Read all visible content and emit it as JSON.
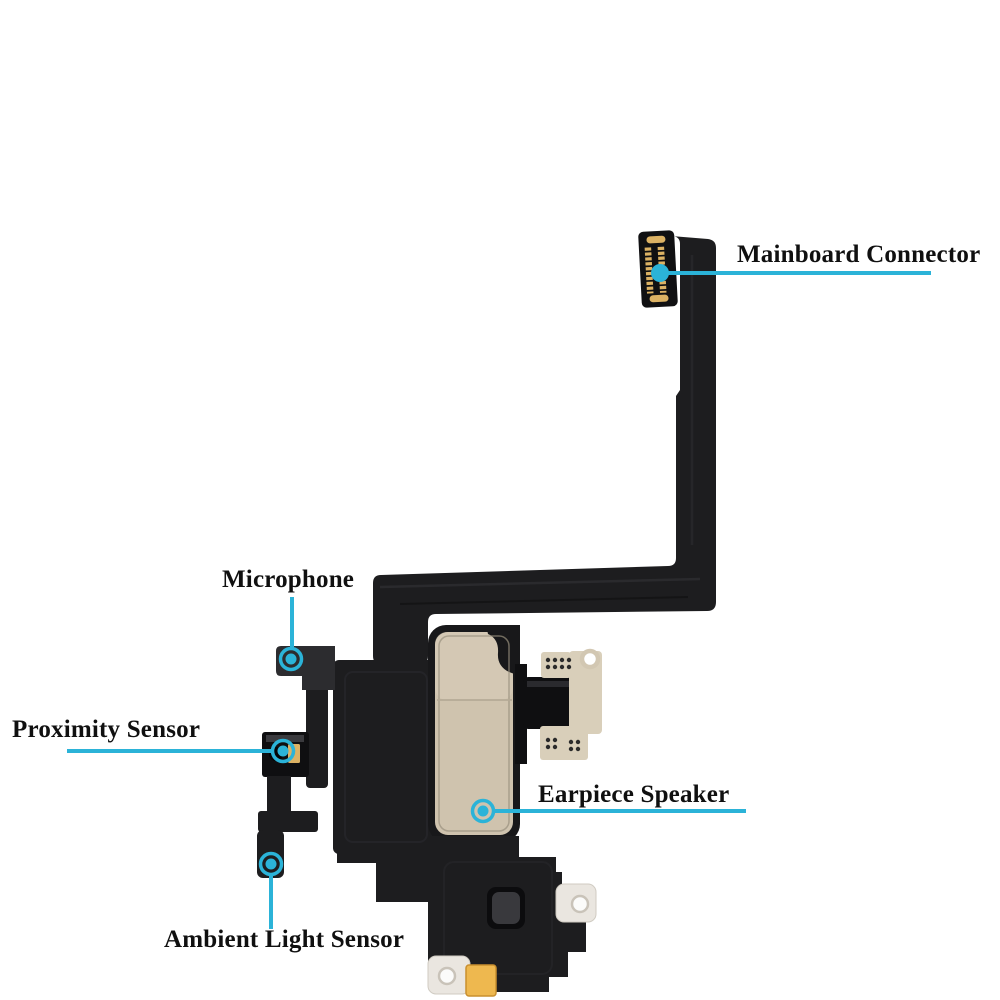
{
  "callouts": [
    {
      "id": "mainboard-connector",
      "label": "Mainboard Connector"
    },
    {
      "id": "microphone",
      "label": "Microphone"
    },
    {
      "id": "proximity-sensor",
      "label": "Proximity Sensor"
    },
    {
      "id": "earpiece-speaker",
      "label": "Earpiece Speaker"
    },
    {
      "id": "ambient-light-sensor",
      "label": "Ambient Light Sensor"
    }
  ],
  "colors": {
    "accent": "#2bb3d8",
    "label_text": "#101010",
    "background": "#ffffff",
    "flex_cable": "#1d1d1f",
    "flex_light": "#2c2c2f",
    "dark_part": "#0f0f11",
    "speaker_plate": "#cfc3ae",
    "plate_light": "#d7ccb8",
    "bracket": "#d9cfba",
    "gold_contact": "#dcb264",
    "gold_pad": "#eeb84f",
    "silver_tab": "#eae6e0"
  }
}
